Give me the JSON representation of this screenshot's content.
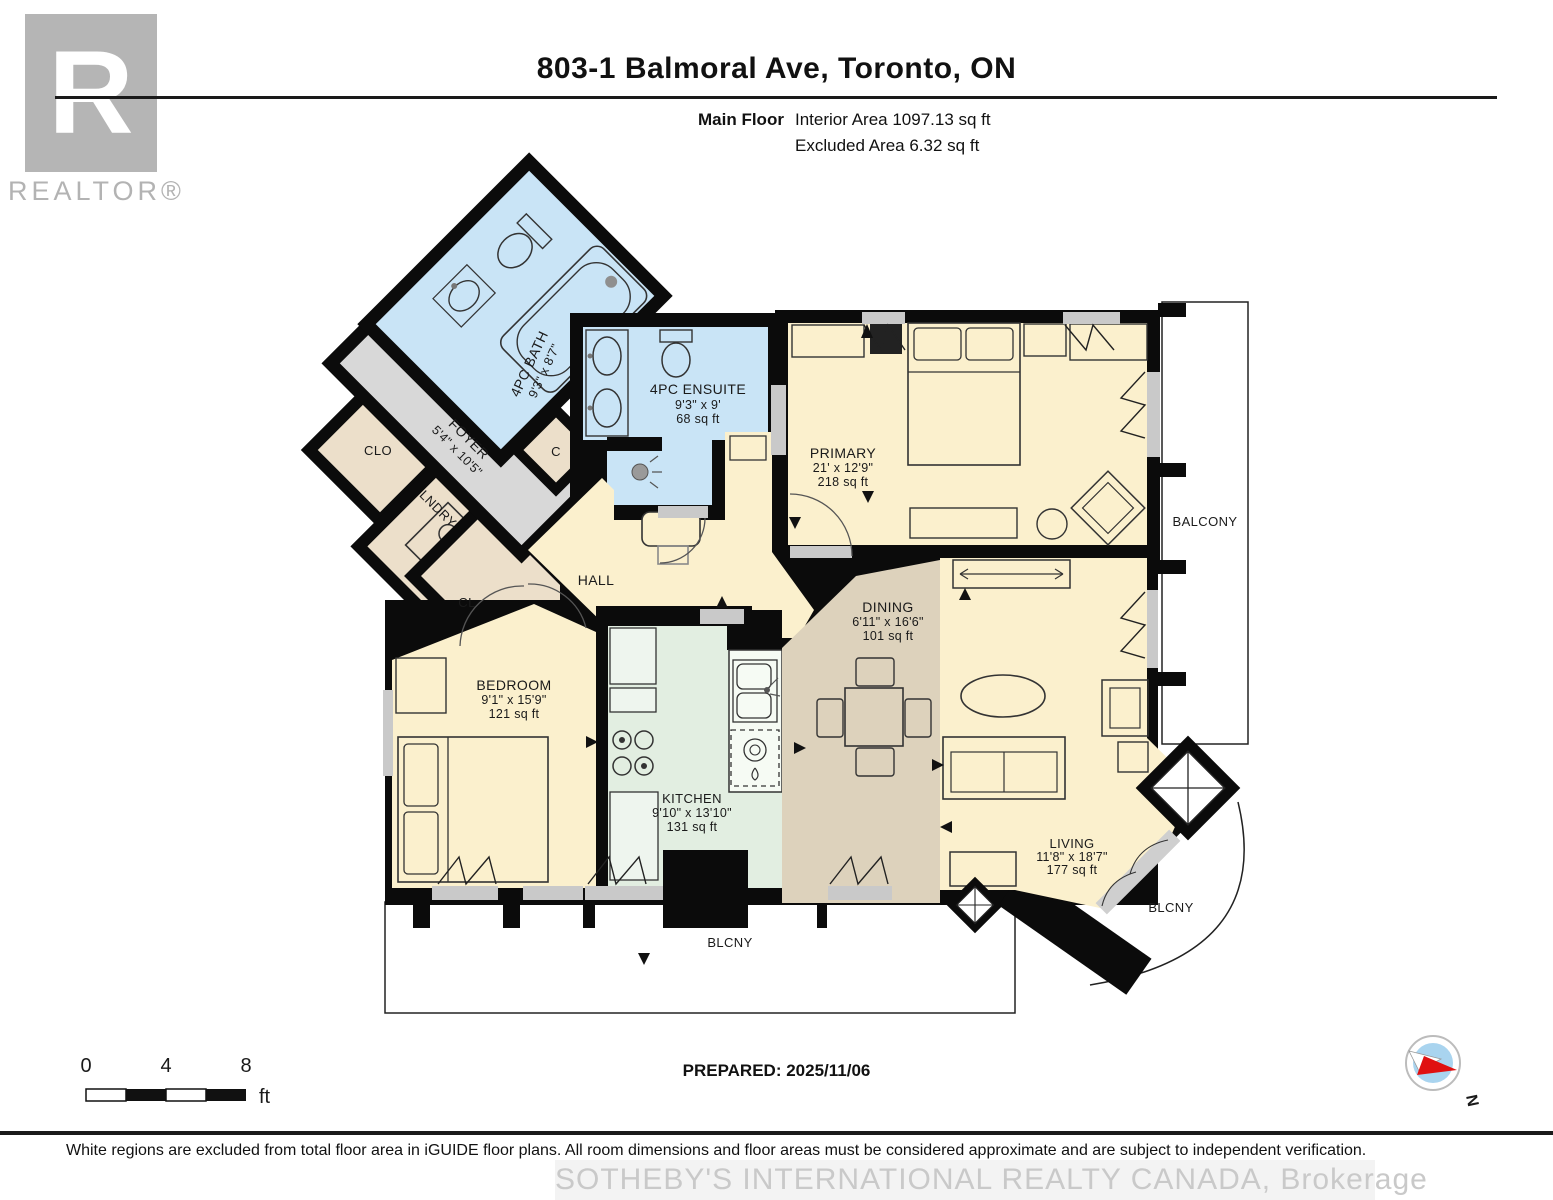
{
  "header": {
    "title": "803-1 Balmoral Ave, Toronto, ON",
    "floor_label": "Main Floor",
    "interior_area": "Interior Area 1097.13 sq ft",
    "excluded_area": "Excluded Area 6.32 sq ft"
  },
  "logo": {
    "letter": "R",
    "realtor_text": "REALTOR®"
  },
  "rooms": {
    "bath": {
      "name": "4PC BATH",
      "dims": "9'3\" x 8'7\""
    },
    "ensuite": {
      "name": "4PC ENSUITE",
      "dims": "9'3\" x 9'",
      "area": "68 sq ft"
    },
    "primary": {
      "name": "PRIMARY",
      "dims": "21' x 12'9\"",
      "area": "218 sq ft"
    },
    "foyer": {
      "name": "FOYER",
      "dims": "5'4\" x 10'5\""
    },
    "clo": {
      "name": "CLO"
    },
    "lndry": {
      "name": "LNDRY"
    },
    "cl": {
      "name": "CL"
    },
    "c": {
      "name": "C"
    },
    "hall": {
      "name": "HALL"
    },
    "bedroom": {
      "name": "BEDROOM",
      "dims": "9'1\" x 15'9\"",
      "area": "121 sq ft"
    },
    "kitchen": {
      "name": "KITCHEN",
      "dims": "9'10\" x 13'10\"",
      "area": "131 sq ft"
    },
    "dining": {
      "name": "DINING",
      "dims": "6'11\" x 16'6\"",
      "area": "101 sq ft"
    },
    "living": {
      "name": "LIVING",
      "dims": "11'8\" x 18'7\"",
      "area": "177 sq ft"
    },
    "balcony_right": {
      "name": "BALCONY"
    },
    "blcny_bottom": {
      "name": "BLCNY"
    },
    "blcny_corner": {
      "name": "BLCNY"
    }
  },
  "scale": {
    "zero": "0",
    "four": "4",
    "eight": "8",
    "unit": "ft"
  },
  "prepared": "PREPARED: 2025/11/06",
  "compass": {
    "north": "N"
  },
  "footer": {
    "disclaimer": "White regions are excluded from total floor area in iGUIDE floor plans. All room dimensions and floor areas must be considered approximate and are subject to independent verification.",
    "watermark": "SOTHEBY'S INTERNATIONAL REALTY CANADA, Brokerage"
  },
  "colors": {
    "wall": "#0b0b0b",
    "bath_blue": "#c9e4f6",
    "room_cream": "#fbf0cd",
    "kitchen_mint": "#e2eee1",
    "dining_tan": "#ddd2bc",
    "foyer_gray": "#d8d8d8",
    "closet_beige": "#ecdfca",
    "window_gray": "#c9c9c9",
    "compass_blue": "#a9d4ef",
    "compass_red": "#e01010",
    "logo_gray": "#b5b5b5"
  }
}
